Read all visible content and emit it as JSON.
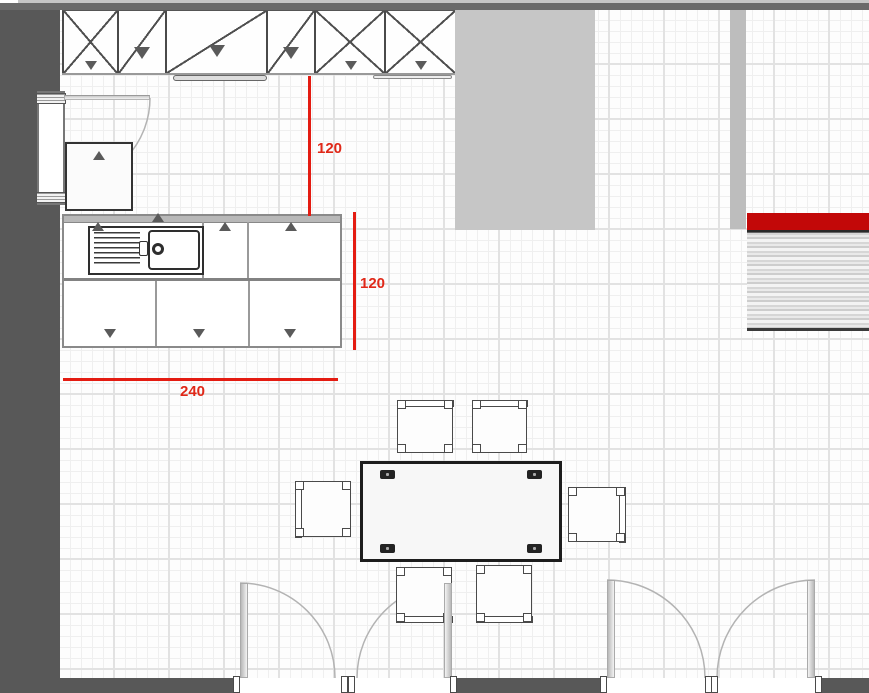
{
  "dimensions": {
    "gap_upper_run": {
      "label": "120"
    },
    "counter_depth": {
      "label": "120"
    },
    "counter_width": {
      "label": "240"
    }
  },
  "colors": {
    "wall": "#585858",
    "wall-top": "#6a6a6a",
    "dim-line": "#e41c12",
    "dim-text": "#e02818",
    "accent-bar": "#c20808",
    "island": "#c6c6c6",
    "pillar": "#bdbdbd"
  }
}
